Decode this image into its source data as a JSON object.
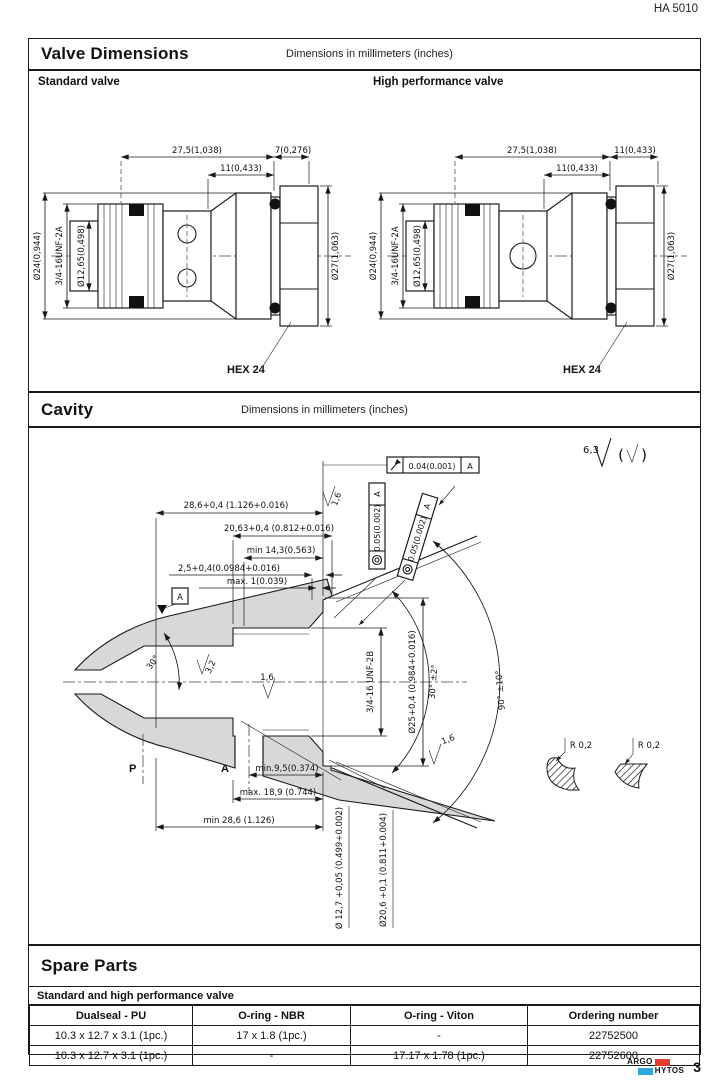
{
  "page": {
    "doc_number": "HA 5010",
    "page_number": "3",
    "logo": {
      "argo": "ARGO",
      "hytos": "HYTOS",
      "red": "#e8392e",
      "blue": "#2fa8e0"
    }
  },
  "valve_dimensions": {
    "title": "Valve Dimensions",
    "units_note": "Dimensions in millimeters (inches)",
    "standard": {
      "label": "Standard valve",
      "dims": {
        "top_len": "27,5(1,038)",
        "top_right": "7(0,276)",
        "mid_len": "11(0,433)",
        "dia_body": "Ø24(0,944)",
        "thread": "3/4-16UNF-2A",
        "dia_inner": "Ø12,65(0,498)",
        "dia_hex": "Ø27(1,063)",
        "hex_label": "HEX 24"
      }
    },
    "high_performance": {
      "label": "High performance valve",
      "dims": {
        "top_len": "27,5(1,038)",
        "top_right": "11(0,433)",
        "mid_len": "11(0,433)",
        "dia_body": "Ø24(0,944)",
        "thread": "3/4-16UNF-2A",
        "dia_inner": "Ø12,65(0,498)",
        "dia_hex": "Ø27(1,063)",
        "hex_label": "HEX 24"
      }
    }
  },
  "cavity": {
    "title": "Cavity",
    "units_note": "Dimensions in millimeters (inches)",
    "dims": {
      "d1": "28,6+0,4 (1.126+0.016)",
      "d2": "20,63+0,4 (0.812+0.016)",
      "d3": "min 14,3(0.563)",
      "d4": "2,5+0,4(0.0984+0.016)",
      "d5": "max. 1(0.039)",
      "runout_tol": "0.04(0.001)",
      "conc_tol": "0.05(0.002)",
      "datum": "A",
      "surf_63": "6,3",
      "surf_32": "3,2",
      "surf_16": "1,6",
      "angle_30": "30°",
      "angle_30_tol": "30° ±2°",
      "angle_90_tol": "90° ±10°",
      "thread": "3/4-16 UNF-2B",
      "dia_25": "Ø25+0,4 (0.984+0.016)",
      "dia_127": "Ø 12,7 +0,05 (0.499+0.002)",
      "dia_206": "Ø20,6 +0,1 (0.811+0.004)",
      "min_95": "min.9,5(0.374)",
      "max_189": "max. 18,9 (0.744)",
      "min_286": "min 28,6 (1.126)",
      "r02": "R 0,2",
      "port_p": "P",
      "port_a": "A"
    }
  },
  "spare_parts": {
    "title": "Spare Parts",
    "subtitle": "Standard and high performance valve",
    "headers": [
      "Dualseal - PU",
      "O-ring - NBR",
      "O-ring - Viton",
      "Ordering number"
    ],
    "rows": [
      [
        "10.3  x 12.7 x 3.1  (1pc.)",
        "17 x 1.8  (1pc.)",
        "-",
        "22752500"
      ],
      [
        "10.3  x 12.7 x 3.1  (1pc.)",
        "-",
        "17.17 x 1.78  (1pc.)",
        "22752600"
      ]
    ]
  }
}
